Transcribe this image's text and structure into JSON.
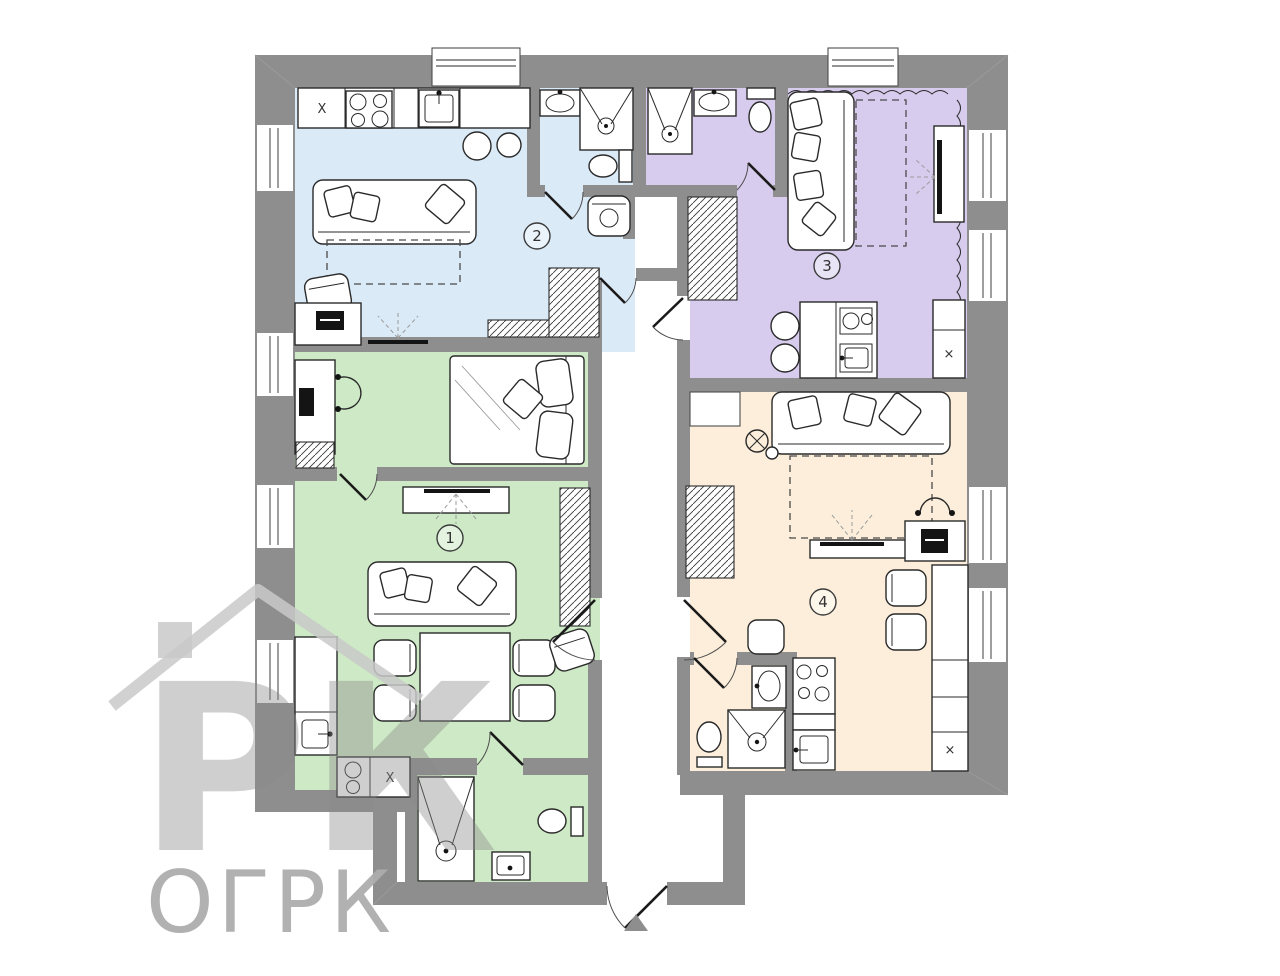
{
  "watermark": {
    "logo_letters": "РК",
    "text": "ОГРК"
  },
  "plan": {
    "wall_color": "#8e8e8e",
    "rooms": [
      {
        "label": "1",
        "floor_color": "#cde9c5"
      },
      {
        "label": "2",
        "floor_color": "#dbeaf7"
      },
      {
        "label": "3",
        "floor_color": "#d8ccee"
      },
      {
        "label": "4",
        "floor_color": "#fceedb"
      }
    ],
    "marks": {
      "kitchen_unit2": "X",
      "kitchen_unit1": "X",
      "cabinet_unit3": "×",
      "cabinet_unit4": "×"
    }
  }
}
